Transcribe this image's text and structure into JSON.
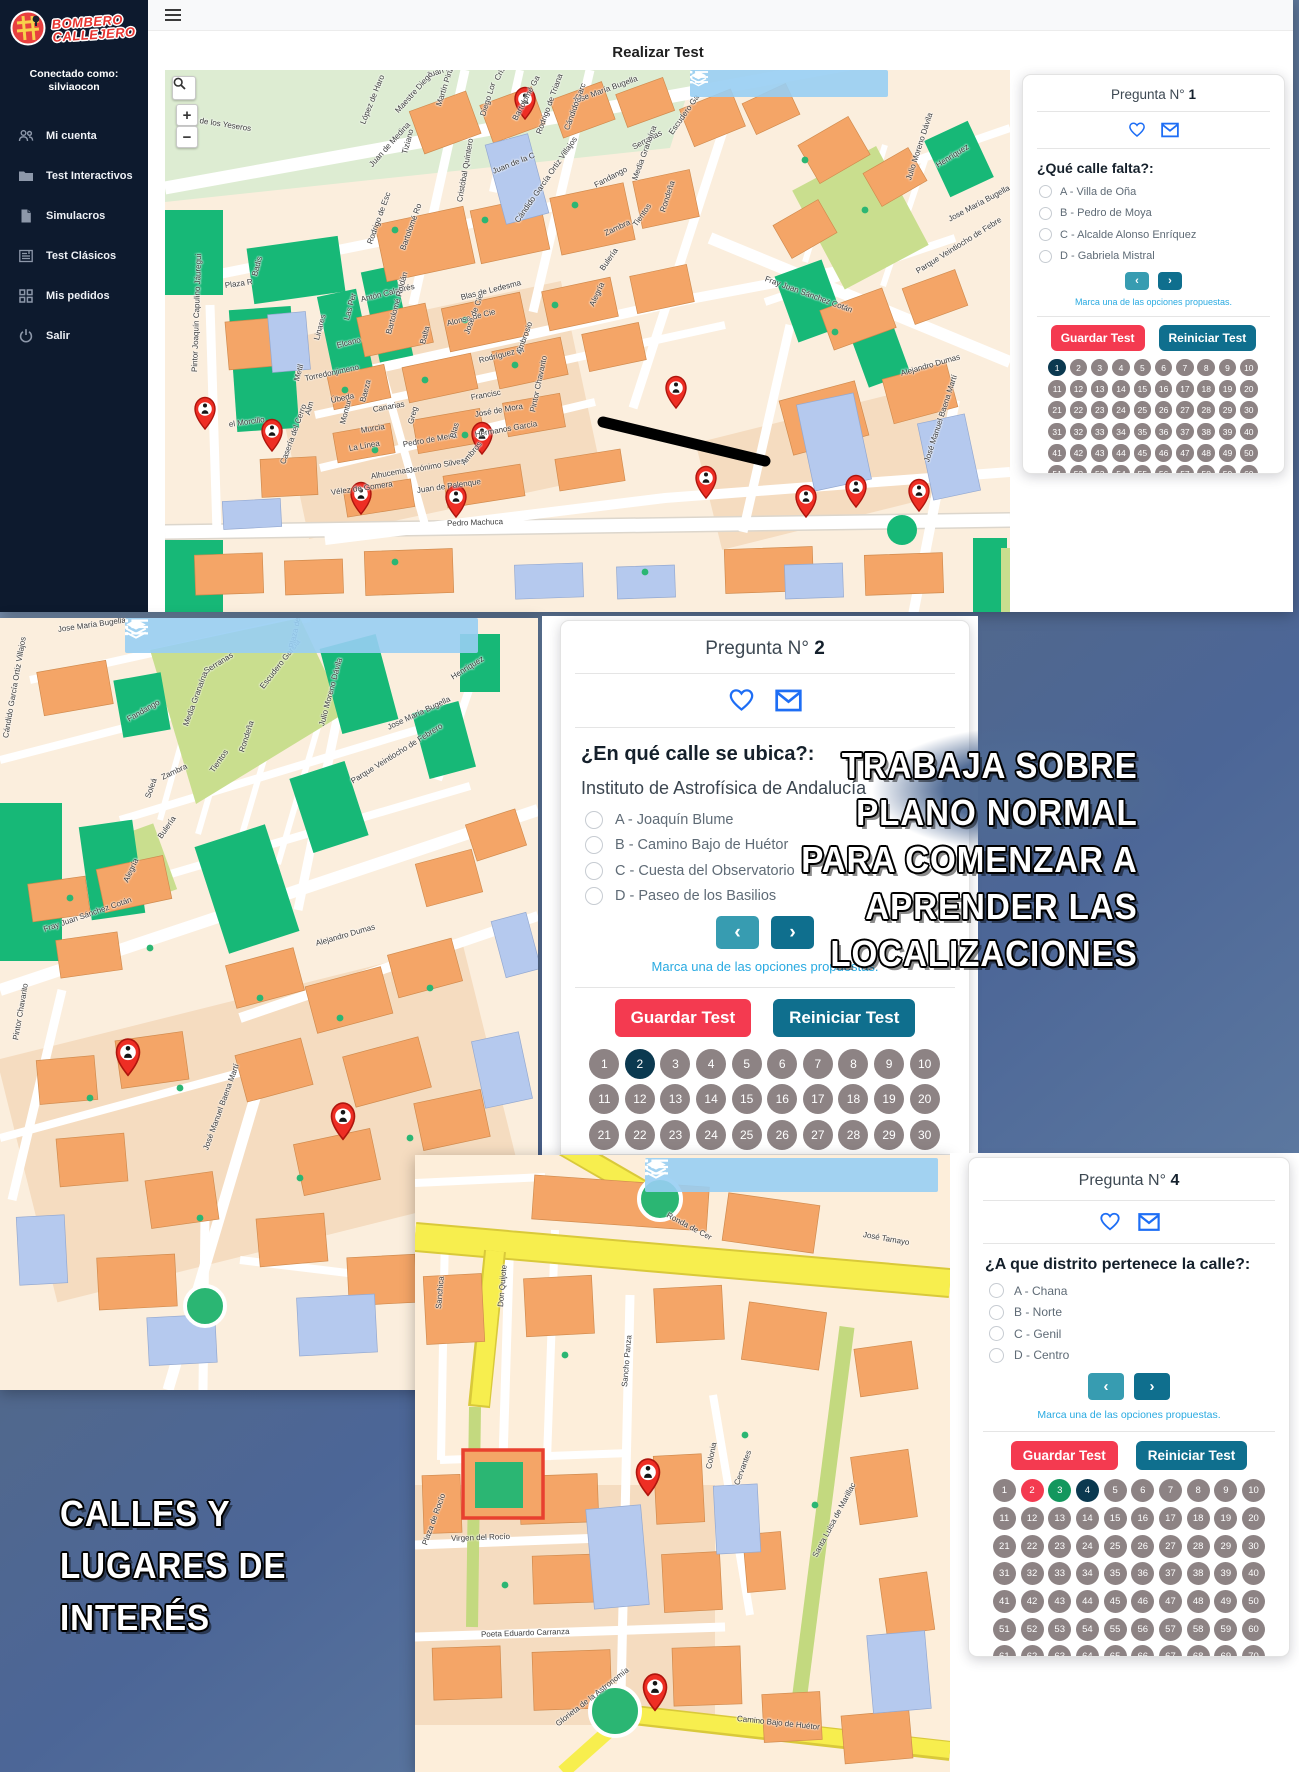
{
  "app": {
    "page_title": "Realizar Test",
    "logo_line1": "BOMBERO",
    "logo_line2": "CALLEJERO",
    "connected_label": "Conectado como:",
    "username": "silviaocon",
    "sidebar_items": [
      {
        "label": "Mi cuenta",
        "icon": "users-icon"
      },
      {
        "label": "Test Interactivos",
        "icon": "folder-icon"
      },
      {
        "label": "Simulacros",
        "icon": "document-icon"
      },
      {
        "label": "Test Clásicos",
        "icon": "news-icon"
      },
      {
        "label": "Mis pedidos",
        "icon": "grid-icon"
      },
      {
        "label": "Salir",
        "icon": "power-icon"
      }
    ],
    "map_zoom_in": "+",
    "map_zoom_out": "−"
  },
  "questions": {
    "q1": {
      "title_prefix": "Pregunta N°",
      "number": "1",
      "question": "¿Qué calle falta?:",
      "options": [
        "A - Villa de Oña",
        "B - Pedro de Moya",
        "C - Alcalde Alonso Enríquez",
        "D - Gabriela Mistral"
      ],
      "prev": "‹",
      "next": "›",
      "hint": "Marca una de las opciones propuestas.",
      "save_label": "Guardar Test",
      "reset_label": "Reiniciar Test",
      "grid": {
        "total": 70,
        "current": 1,
        "wrong": [],
        "correct": []
      }
    },
    "q2": {
      "title_prefix": "Pregunta N°",
      "number": "2",
      "question": "¿En qué calle se ubica?:",
      "subtitle": "Instituto de Astrofísica de Andalucía",
      "options": [
        "A - Joaquín Blume",
        "B - Camino Bajo de Huétor",
        "C - Cuesta del Observatorio",
        "D - Paseo de los Basilios"
      ],
      "prev": "‹",
      "next": "›",
      "hint": "Marca una de las opciones propuestas.",
      "save_label": "Guardar Test",
      "reset_label": "Reiniciar Test",
      "grid": {
        "total": 70,
        "current": 2,
        "wrong": [],
        "correct": []
      }
    },
    "q4": {
      "title_prefix": "Pregunta N°",
      "number": "4",
      "question": "¿A que distrito pertenece la calle?:",
      "options": [
        "A - Chana",
        "B - Norte",
        "C - Genil",
        "D - Centro"
      ],
      "prev": "‹",
      "next": "›",
      "hint": "Marca una de las opciones propuestas.",
      "save_label": "Guardar Test",
      "reset_label": "Reiniciar Test",
      "grid": {
        "total": 70,
        "current": 4,
        "wrong": [
          2
        ],
        "correct": [
          3
        ]
      }
    }
  },
  "overlay_texts": {
    "right_lines": [
      "TRABAJA SOBRE",
      "PLANO NORMAL",
      "PARA COMENZAR A",
      "APRENDER LAS",
      "LOCALIZACIONES"
    ],
    "left_lines": [
      "CALLES Y",
      "LUGARES DE",
      "INTERÉS"
    ]
  },
  "maps": {
    "top": {
      "labels": [
        {
          "t": "o de los Yeseros",
          "x": 28,
          "y": 46,
          "r": 9
        },
        {
          "t": "Juan Niño",
          "x": 262,
          "y": 2,
          "r": -18
        },
        {
          "t": "López de Haro",
          "x": 198,
          "y": 50,
          "r": -68
        },
        {
          "t": "Maestre Diego",
          "x": 232,
          "y": 38,
          "r": -48
        },
        {
          "t": "Tiziano",
          "x": 240,
          "y": 80,
          "r": -75
        },
        {
          "t": "Juan de Medina",
          "x": 206,
          "y": 92,
          "r": -48
        },
        {
          "t": "Martín Pinzón",
          "x": 274,
          "y": 32,
          "r": -72
        },
        {
          "t": "Cristóbal Caro",
          "x": 332,
          "y": 6,
          "r": -62
        },
        {
          "t": "Diego Lor",
          "x": 318,
          "y": 42,
          "r": -72
        },
        {
          "t": "Bartolomé Ga",
          "x": 350,
          "y": 46,
          "r": -62
        },
        {
          "t": "Juan de la C",
          "x": 328,
          "y": 98,
          "r": -22
        },
        {
          "t": "Cristóbal Quintero",
          "x": 295,
          "y": 128,
          "r": -80
        },
        {
          "t": "Rodrigo de Triana",
          "x": 374,
          "y": 60,
          "r": -70
        },
        {
          "t": "Jose María Bugella",
          "x": 408,
          "y": 28,
          "r": -20
        },
        {
          "t": "Cándido Garc",
          "x": 402,
          "y": 56,
          "r": -70
        },
        {
          "t": "Cándido García Ortiz Villajos",
          "x": 352,
          "y": 148,
          "r": -55
        },
        {
          "t": "Serranas",
          "x": 468,
          "y": 74,
          "r": -28
        },
        {
          "t": "Escudero Ga",
          "x": 506,
          "y": 60,
          "r": -55
        },
        {
          "t": "Fandango",
          "x": 430,
          "y": 112,
          "r": -28
        },
        {
          "t": "Media Granaína",
          "x": 470,
          "y": 106,
          "r": -70
        },
        {
          "t": "Rondeña",
          "x": 498,
          "y": 138,
          "r": -72
        },
        {
          "t": "Tientos",
          "x": 470,
          "y": 152,
          "r": -55
        },
        {
          "t": "Zambra",
          "x": 440,
          "y": 160,
          "r": -25
        },
        {
          "t": "Bulería",
          "x": 437,
          "y": 196,
          "r": -55
        },
        {
          "t": "Alegría",
          "x": 427,
          "y": 232,
          "r": -65
        },
        {
          "t": "Fray Juan Sánchez Cotán",
          "x": 600,
          "y": 205,
          "r": 20
        },
        {
          "t": "Rodrigo de Esc",
          "x": 205,
          "y": 170,
          "r": -70
        },
        {
          "t": "Bartolomé Ro",
          "x": 238,
          "y": 176,
          "r": -70
        },
        {
          "t": "Antón Calabrés",
          "x": 196,
          "y": 226,
          "r": -14
        },
        {
          "t": "Las Per",
          "x": 182,
          "y": 246,
          "r": -75
        },
        {
          "t": "Elcano",
          "x": 172,
          "y": 272,
          "r": -14
        },
        {
          "t": "Bartolomé Roldán",
          "x": 224,
          "y": 260,
          "r": -75
        },
        {
          "t": "Linares",
          "x": 152,
          "y": 266,
          "r": -75
        },
        {
          "t": "Blas de Ledesma",
          "x": 296,
          "y": 224,
          "r": -14
        },
        {
          "t": "Alonso de Cie",
          "x": 282,
          "y": 250,
          "r": -14
        },
        {
          "t": "José de Cie",
          "x": 302,
          "y": 260,
          "r": -70
        },
        {
          "t": "Balta",
          "x": 258,
          "y": 270,
          "r": -75
        },
        {
          "t": "Rodríguez Bl",
          "x": 314,
          "y": 287,
          "r": -14
        },
        {
          "t": "Ambrosio",
          "x": 354,
          "y": 280,
          "r": -70
        },
        {
          "t": "Torredonjimeno",
          "x": 140,
          "y": 305,
          "r": -12
        },
        {
          "t": "Metil",
          "x": 132,
          "y": 307,
          "r": -75
        },
        {
          "t": "Úbeda",
          "x": 166,
          "y": 327,
          "r": -12
        },
        {
          "t": "Baeza",
          "x": 198,
          "y": 328,
          "r": -75
        },
        {
          "t": "Canarias",
          "x": 208,
          "y": 336,
          "r": -10
        },
        {
          "t": "Alm",
          "x": 143,
          "y": 341,
          "r": -75
        },
        {
          "t": "Montur",
          "x": 178,
          "y": 350,
          "r": -75
        },
        {
          "t": "Murcia",
          "x": 196,
          "y": 357,
          "r": -10
        },
        {
          "t": "La Línea",
          "x": 184,
          "y": 375,
          "r": -10
        },
        {
          "t": "Pedro de Mena",
          "x": 238,
          "y": 371,
          "r": -10
        },
        {
          "t": "Greg",
          "x": 246,
          "y": 350,
          "r": -75
        },
        {
          "t": "Blas",
          "x": 288,
          "y": 364,
          "r": -75
        },
        {
          "t": "Francisc",
          "x": 306,
          "y": 324,
          "r": -10
        },
        {
          "t": "José de Mora",
          "x": 310,
          "y": 341,
          "r": -10
        },
        {
          "t": "Hermanos García",
          "x": 310,
          "y": 361,
          "r": -10
        },
        {
          "t": "Jerónimo Silvest",
          "x": 244,
          "y": 397,
          "r": -10
        },
        {
          "t": "Ambros",
          "x": 298,
          "y": 390,
          "r": -50
        },
        {
          "t": "Alhucemas",
          "x": 206,
          "y": 403,
          "r": -10
        },
        {
          "t": "Vélez de Gomera",
          "x": 166,
          "y": 419,
          "r": -8
        },
        {
          "t": "Juan de Palenque",
          "x": 252,
          "y": 417,
          "r": -8
        },
        {
          "t": "Pintor Chavarito",
          "x": 368,
          "y": 338,
          "r": -78
        },
        {
          "t": "Pedro Machuca",
          "x": 282,
          "y": 450,
          "r": -2
        },
        {
          "t": "Pintor Joaquín Capulino Jáuregui",
          "x": 30,
          "y": 298,
          "r": -88
        },
        {
          "t": "el Morcillo",
          "x": 64,
          "y": 351,
          "r": -8
        },
        {
          "t": "Casería del Cerro",
          "x": 118,
          "y": 390,
          "r": -70
        },
        {
          "t": "Plaza R",
          "x": 60,
          "y": 212,
          "r": -8
        },
        {
          "t": "Badis",
          "x": 90,
          "y": 202,
          "r": -75
        },
        {
          "t": "José Manuel Baena Martí",
          "x": 762,
          "y": 388,
          "r": -72
        },
        {
          "t": "Julio Moreno Dávila",
          "x": 744,
          "y": 106,
          "r": -72
        },
        {
          "t": "Henríquez",
          "x": 772,
          "y": 92,
          "r": -32
        },
        {
          "t": "Jose María Bugella",
          "x": 784,
          "y": 146,
          "r": -28
        },
        {
          "t": "Parque Veintiocho de Febre",
          "x": 752,
          "y": 198,
          "r": -32
        },
        {
          "t": "Alejandro Dumas",
          "x": 736,
          "y": 300,
          "r": -16
        }
      ]
    },
    "middle": {
      "labels": [
        {
          "t": "Jose María Bugella",
          "x": 58,
          "y": 8,
          "r": -8
        },
        {
          "t": "Cándido García Ortiz Villajos",
          "x": 6,
          "y": 116,
          "r": -80
        },
        {
          "t": "Serranas",
          "x": 205,
          "y": 50,
          "r": -32
        },
        {
          "t": "Escudero García",
          "x": 262,
          "y": 66,
          "r": -52
        },
        {
          "t": "Plaza de Jesús",
          "x": 292,
          "y": 26,
          "r": -78
        },
        {
          "t": "Fandango",
          "x": 128,
          "y": 98,
          "r": -30
        },
        {
          "t": "Media Granaína",
          "x": 186,
          "y": 104,
          "r": -70
        },
        {
          "t": "Tientos",
          "x": 212,
          "y": 150,
          "r": -55
        },
        {
          "t": "Rondeña",
          "x": 242,
          "y": 130,
          "r": -72
        },
        {
          "t": "Zambra",
          "x": 162,
          "y": 156,
          "r": -25
        },
        {
          "t": "Soleá",
          "x": 148,
          "y": 176,
          "r": -70
        },
        {
          "t": "Bulería",
          "x": 160,
          "y": 216,
          "r": -55
        },
        {
          "t": "Alegría",
          "x": 126,
          "y": 260,
          "r": -65
        },
        {
          "t": "Julio Moreno Dávila",
          "x": 322,
          "y": 104,
          "r": -75
        },
        {
          "t": "Jose María Bugella",
          "x": 388,
          "y": 106,
          "r": -25
        },
        {
          "t": "Henríquez",
          "x": 452,
          "y": 56,
          "r": -32
        },
        {
          "t": "Parque Veintiocho de Febrero",
          "x": 352,
          "y": 160,
          "r": -32
        },
        {
          "t": "Fray Juan Sánchez Cotán",
          "x": 44,
          "y": 308,
          "r": -19
        },
        {
          "t": "Alejandro Dumas",
          "x": 316,
          "y": 322,
          "r": -16
        },
        {
          "t": "Pintor Chavarito",
          "x": 16,
          "y": 418,
          "r": -80
        },
        {
          "t": "José Manuel Baena Martí",
          "x": 206,
          "y": 528,
          "r": -70
        }
      ]
    },
    "bottom": {
      "labels": [
        {
          "t": "Ronda de Cer",
          "x": 252,
          "y": 56,
          "r": 28
        },
        {
          "t": "José Tamayo",
          "x": 448,
          "y": 76,
          "r": 10
        },
        {
          "t": "Don Quijote",
          "x": 86,
          "y": 148,
          "r": -85
        },
        {
          "t": "Sanchica",
          "x": 24,
          "y": 150,
          "r": -85
        },
        {
          "t": "Sancho Panza",
          "x": 210,
          "y": 228,
          "r": -85
        },
        {
          "t": "Virgen del Rocío",
          "x": 36,
          "y": 380,
          "r": -2
        },
        {
          "t": "Plaza de Rocío",
          "x": 10,
          "y": 386,
          "r": -70
        },
        {
          "t": "Poeta Eduardo Carranza",
          "x": 66,
          "y": 476,
          "r": -2
        },
        {
          "t": "Colonia",
          "x": 294,
          "y": 310,
          "r": -78
        },
        {
          "t": "Cervantes",
          "x": 322,
          "y": 326,
          "r": -70
        },
        {
          "t": "Santa Luisa de Marillac",
          "x": 400,
          "y": 398,
          "r": -62
        },
        {
          "t": "Camino Bajo de Huétor",
          "x": 322,
          "y": 560,
          "r": 6
        },
        {
          "t": "Glorieta de la Astronomía",
          "x": 142,
          "y": 566,
          "r": -38
        }
      ]
    }
  }
}
